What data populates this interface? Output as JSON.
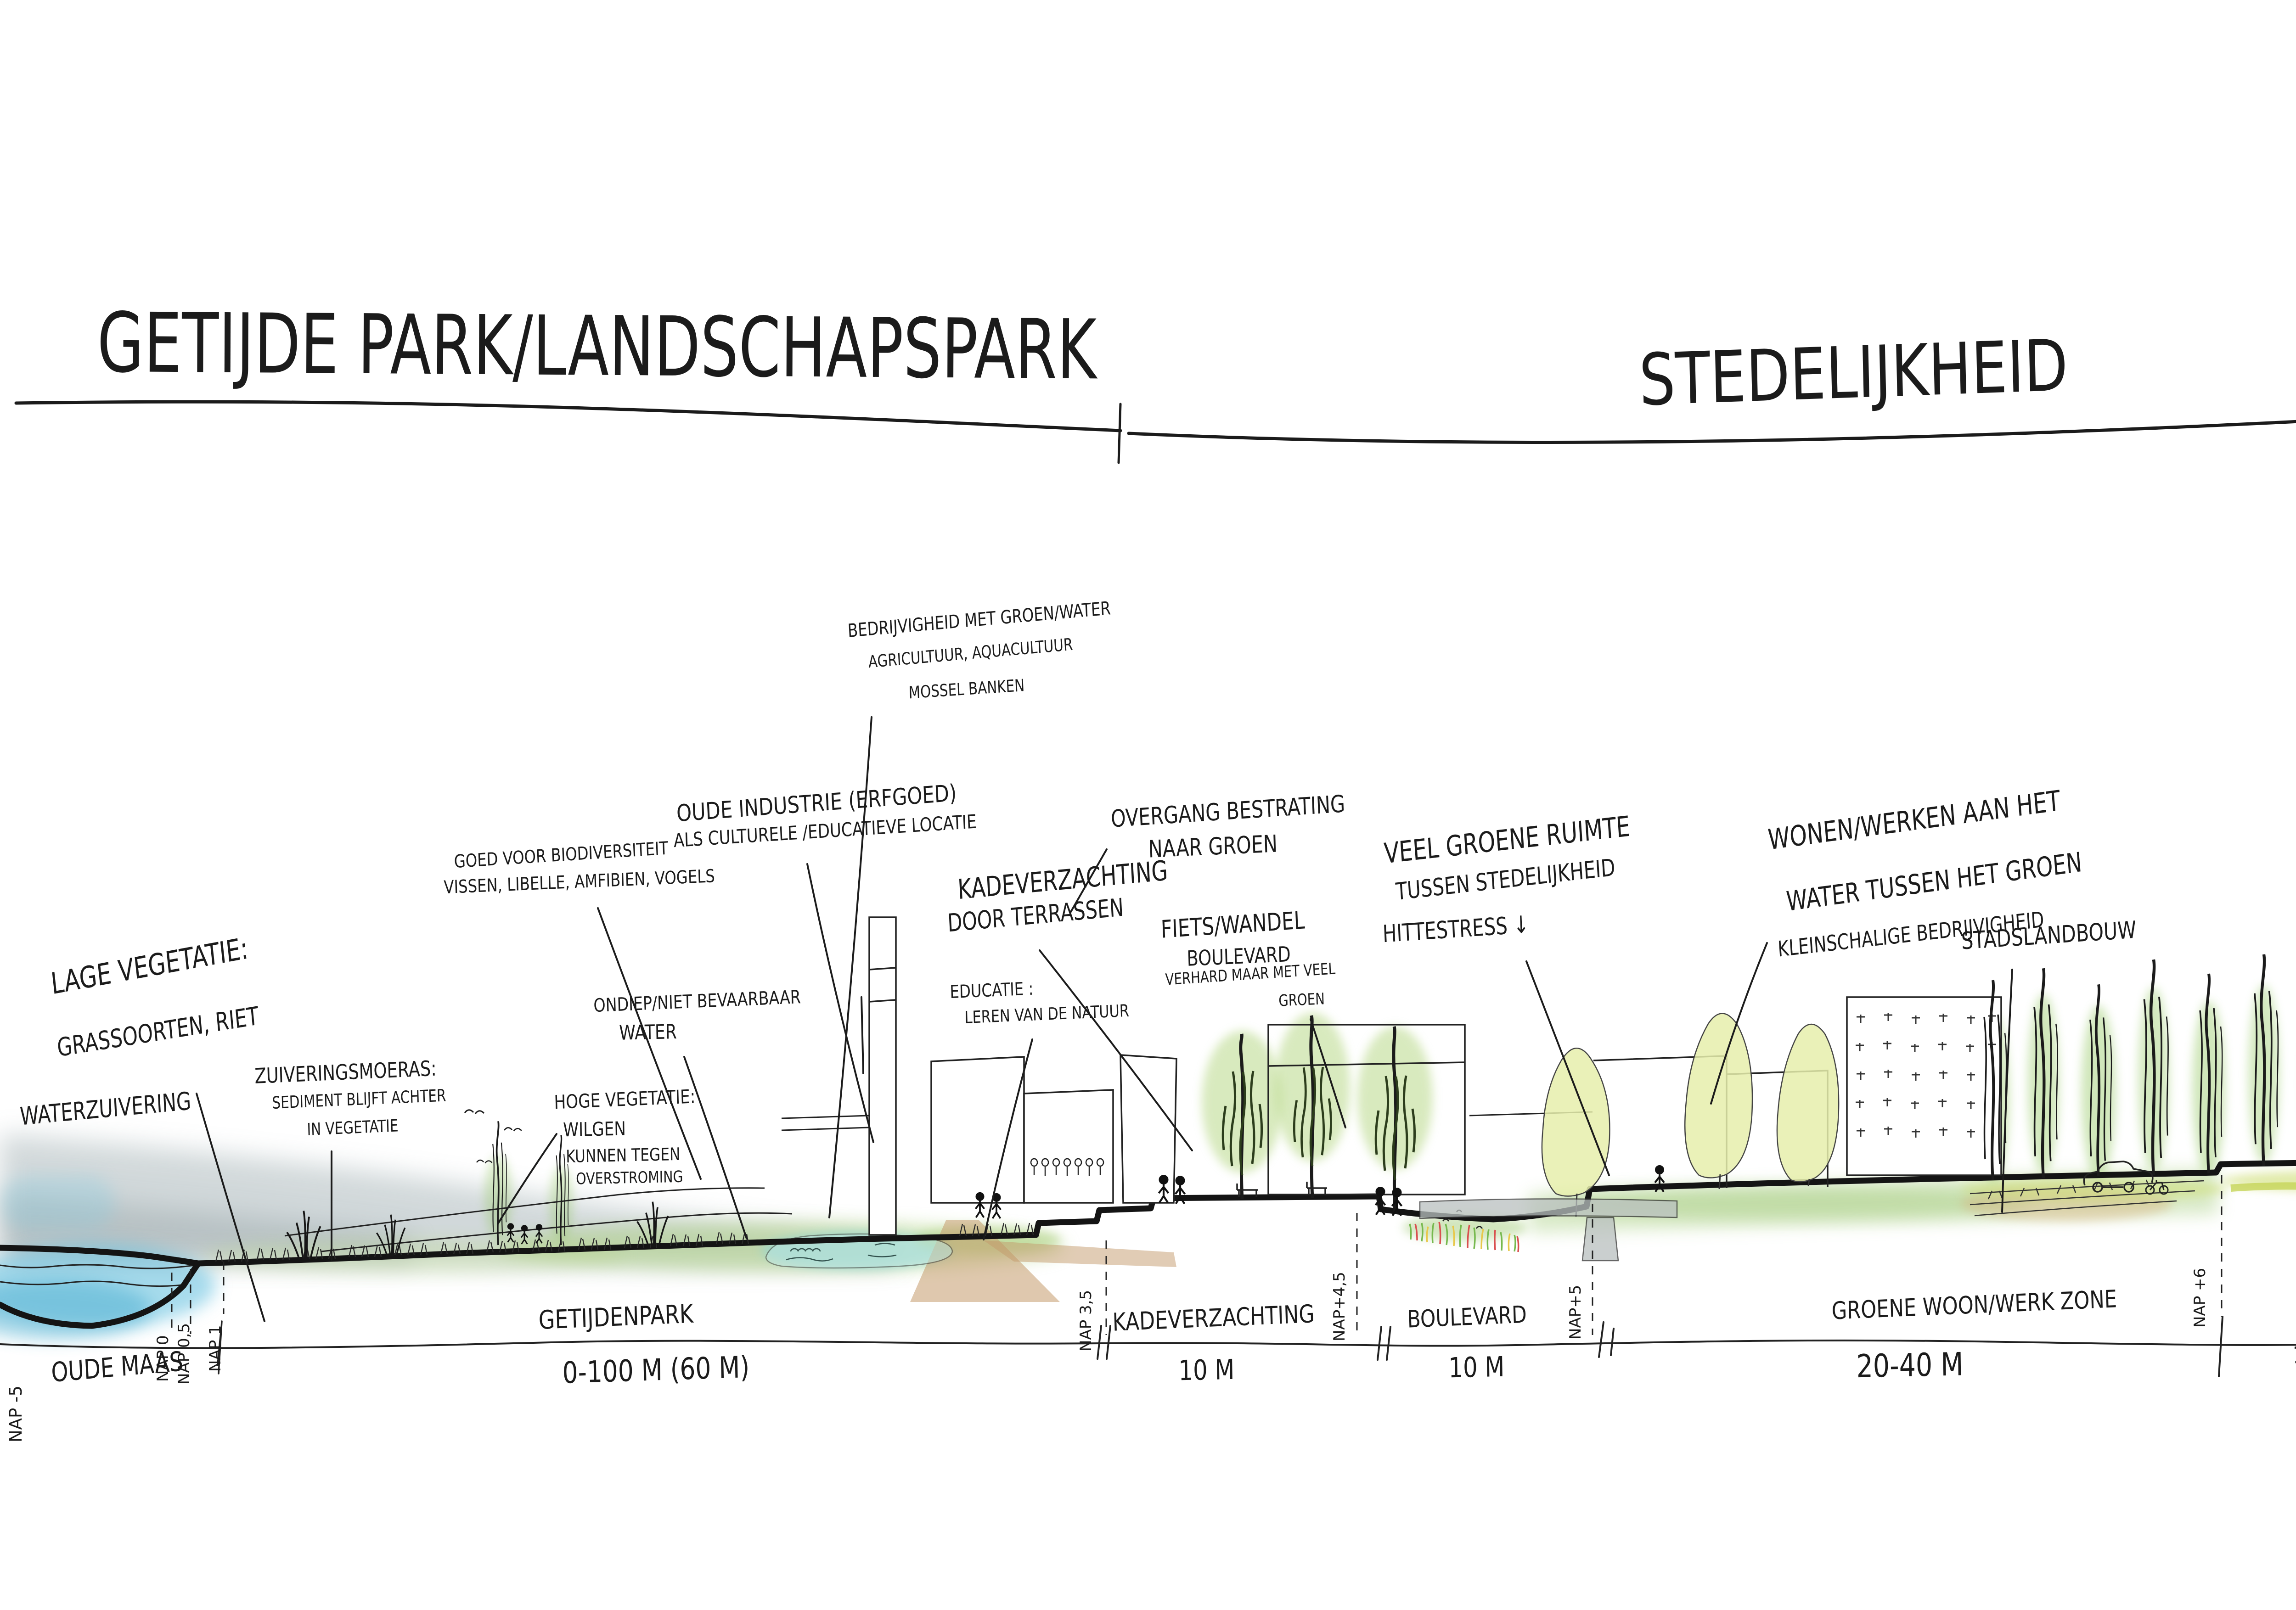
{
  "titles": {
    "left": "GETIJDE PARK/LANDSCHAPSPARK",
    "right": "STEDELIJKHEID"
  },
  "annotations": {
    "bedrijvigheid": {
      "l1": "BEDRIJVIGHEID MET GROEN/WATER",
      "l2": "AGRICULTUUR, AQUACULTUUR",
      "l3": "MOSSEL BANKEN"
    },
    "oude_industrie": {
      "l1": "OUDE INDUSTRIE (ERFGOED)",
      "l2": "ALS CULTURELE /EDUCATIEVE LOCATIE"
    },
    "biodiversiteit": {
      "l1": "GOED VOOR BIODIVERSITEIT",
      "l2": "VISSEN, LIBELLE, AMFIBIEN, VOGELS"
    },
    "lage_vegetatie": {
      "l1": "LAGE VEGETATIE:",
      "l2": "GRASSOORTEN, RIET",
      "l3": "WATERZUIVERING"
    },
    "zuiveringsmoeras": {
      "l1": "ZUIVERINGSMOERAS:",
      "l2": "SEDIMENT BLIJFT ACHTER",
      "l3": "IN VEGETATIE"
    },
    "ondiep": {
      "l1": "ONDIEP/NIET BEVAARBAAR",
      "l2": "WATER"
    },
    "hoge_vegetatie": {
      "l1": "HOGE VEGETATIE:",
      "l2": "WILGEN",
      "l3": "KUNNEN TEGEN",
      "l4": "OVERSTROMING"
    },
    "educatie": {
      "l1": "EDUCATIE :",
      "l2": "LEREN VAN DE NATUUR"
    },
    "kadeverzachting": {
      "l1": "KADEVERZACHTING",
      "l2": "DOOR TERRASSEN"
    },
    "overgang": {
      "l1": "OVERGANG BESTRATING",
      "l2": "NAAR GROEN"
    },
    "fiets_wandel": {
      "l1": "FIETS/WANDEL",
      "l2": "BOULEVARD",
      "l3": "VERHARD MAAR MET VEEL",
      "l4": "GROEN"
    },
    "veel_groen": {
      "l1": "VEEL GROENE RUIMTE",
      "l2": "TUSSEN STEDELIJKHEID",
      "l3": "HITTESTRESS ↓"
    },
    "wonen_werken": {
      "l1": "WONEN/WERKEN AAN HET",
      "l2": "WATER TUSSEN HET GROEN",
      "l3": "KLEINSCHALIGE BEDRIJVIGHEID"
    },
    "stadslandbouw": {
      "l1": "STADSLANDBOUW"
    },
    "dijk_weg": {
      "l1a": "DIJK ALS",
      "l1b": "ONTSLUITINGSWEG",
      "l2": "GROEN STRAATPROFIEL",
      "l3": "MEER RUIMTE VOOR FIETS",
      "l4": "VOETGANGER"
    },
    "groene_assen": {
      "l1": "GROENE ASSEN",
      "l2": "DOORZETTEN IN ACHTERLAND",
      "l3": "GROEN VERBINDEN",
      "l4": "BIODIVERSITEIT",
      "arrow": "↑"
    }
  },
  "scale_bar": {
    "oude_maas": "OUDE MAAS",
    "getijdenpark": {
      "name": "GETIJDENPARK",
      "size": "0-100 M (60 M)"
    },
    "kadeverzachting": {
      "name": "KADEVERZACHTING",
      "size": "10 M"
    },
    "boulevard": {
      "name": "BOULEVARD",
      "size": "10 M"
    },
    "woon_werk": {
      "name": "GROENE WOON/WERK ZONE",
      "size": "20-40 M"
    },
    "dijk": {
      "name": "DIJK",
      "size": "17,5 M"
    },
    "achterland": "ACHTERLAND"
  },
  "nap": {
    "m5": "NAP -5",
    "p0": "NAP 0",
    "p05": "NAP 0,5",
    "p1": "NAP 1",
    "p35": "NAP 3,5",
    "p45": "NAP+4,5",
    "p5": "NAP+5",
    "p6": "NAP +6",
    "m1": "NAP -1"
  },
  "colors": {
    "ink": "#1b1b1b",
    "water_blue": "#5fbede",
    "marsh_gray": "#8fa0a4",
    "grass_green": "#a9cf79",
    "tree_light": "#e6eeab",
    "tree_green": "#8cc456",
    "path_brown": "#c49a6c",
    "flower_red": "#d94f4f",
    "flower_yellow": "#e8c84a",
    "pond_teal": "#8fd7d8"
  }
}
